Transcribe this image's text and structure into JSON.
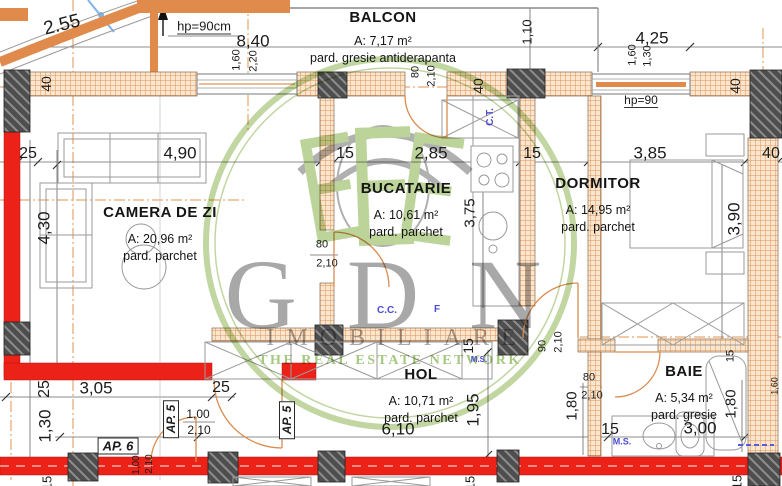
{
  "watermark": {
    "brand": "GDN",
    "subtitle": "IMOBILIARE",
    "tagline": "THE REAL ESTATE NETWORK"
  },
  "rooms": {
    "balcon": {
      "name": "BALCON",
      "area": "A: 7,17 m²",
      "floor": "pard. gresie antiderapanta"
    },
    "camera": {
      "name": "CAMERA DE ZI",
      "area": "A: 20,96 m²",
      "floor": "pard. parchet"
    },
    "bucatarie": {
      "name": "BUCATARIE",
      "area": "A: 10,61 m²",
      "floor": "pard. parchet"
    },
    "dormitor": {
      "name": "DORMITOR",
      "area": "A: 14,95 m²",
      "floor": "pard. parchet"
    },
    "hol": {
      "name": "HOL",
      "area": "A: 10,71 m²",
      "floor": "pard. parchet"
    },
    "baie": {
      "name": "BAIE",
      "area": "A: 5,34 m²",
      "floor": "pard. gresie"
    }
  },
  "labels": [
    {
      "t": "2.55",
      "x": 62,
      "y": 25,
      "r": -14,
      "s": 19
    },
    {
      "t": "hp=90cm",
      "x": 204,
      "y": 27,
      "s": 13,
      "c": "ul"
    },
    {
      "t": "8,40",
      "x": 253,
      "y": 41,
      "s": 17
    },
    {
      "t": "1,10",
      "x": 527,
      "y": 32,
      "r": -90,
      "s": 13
    },
    {
      "t": "4,25",
      "x": 652,
      "y": 38,
      "s": 17
    },
    {
      "t": "1,60",
      "x": 237,
      "y": 60,
      "r": -90,
      "s": 11
    },
    {
      "t": "2,20",
      "x": 254,
      "y": 61,
      "r": -90,
      "s": 11
    },
    {
      "t": "1,60",
      "x": 633,
      "y": 55,
      "r": -90,
      "s": 11
    },
    {
      "t": "1,30",
      "x": 648,
      "y": 56,
      "r": -90,
      "s": 11
    },
    {
      "t": "80",
      "x": 416,
      "y": 72,
      "r": -90,
      "s": 11
    },
    {
      "t": "2,10",
      "x": 432,
      "y": 76,
      "r": -90,
      "s": 11
    },
    {
      "t": "40",
      "x": 478,
      "y": 86,
      "r": -90,
      "s": 14
    },
    {
      "t": "40",
      "x": 46,
      "y": 84,
      "r": -90,
      "s": 14
    },
    {
      "t": "40",
      "x": 735,
      "y": 86,
      "r": -90,
      "s": 14
    },
    {
      "t": "hp=90",
      "x": 641,
      "y": 101,
      "s": 12,
      "c": "ul"
    },
    {
      "t": "25",
      "x": 28,
      "y": 154,
      "s": 16
    },
    {
      "t": "4,90",
      "x": 180,
      "y": 153,
      "s": 17
    },
    {
      "t": "15",
      "x": 345,
      "y": 154,
      "s": 16
    },
    {
      "t": "2,85",
      "x": 431,
      "y": 153,
      "s": 17
    },
    {
      "t": "15",
      "x": 532,
      "y": 154,
      "s": 16
    },
    {
      "t": "3,85",
      "x": 650,
      "y": 153,
      "s": 17
    },
    {
      "t": "40",
      "x": 771,
      "y": 154,
      "s": 16
    },
    {
      "t": "4,30",
      "x": 44,
      "y": 228,
      "r": -90,
      "s": 17
    },
    {
      "t": "3,75",
      "x": 470,
      "y": 213,
      "r": -90,
      "s": 15
    },
    {
      "t": "3,90",
      "x": 734,
      "y": 219,
      "r": -90,
      "s": 17
    },
    {
      "t": "C.T.",
      "x": 491,
      "y": 117,
      "r": -90,
      "s": 10,
      "c": "blue"
    },
    {
      "t": "80",
      "x": 322,
      "y": 245,
      "s": 11
    },
    {
      "t": "2,10",
      "x": 327,
      "y": 264,
      "s": 11
    },
    {
      "t": "C.C.",
      "x": 387,
      "y": 311,
      "s": 10,
      "c": "blue"
    },
    {
      "t": "F",
      "x": 437,
      "y": 310,
      "s": 10,
      "c": "blue"
    },
    {
      "t": "15",
      "x": 468,
      "y": 346,
      "r": -90,
      "s": 14
    },
    {
      "t": "M.S.",
      "x": 479,
      "y": 360,
      "s": 8,
      "c": "blue"
    },
    {
      "t": "90",
      "x": 543,
      "y": 346,
      "r": -90,
      "s": 11
    },
    {
      "t": "2,10",
      "x": 559,
      "y": 342,
      "r": -90,
      "s": 11
    },
    {
      "t": "80",
      "x": 589,
      "y": 378,
      "s": 11
    },
    {
      "t": "2,10",
      "x": 592,
      "y": 396,
      "s": 11
    },
    {
      "t": "1,80",
      "x": 572,
      "y": 406,
      "r": -90,
      "s": 15
    },
    {
      "t": "1,80",
      "x": 731,
      "y": 404,
      "r": -90,
      "s": 15
    },
    {
      "t": "15",
      "x": 731,
      "y": 356,
      "r": -90,
      "s": 11
    },
    {
      "t": "1,60",
      "x": 775,
      "y": 386,
      "r": -90,
      "s": 9
    },
    {
      "t": "25",
      "x": 45,
      "y": 389,
      "r": -90,
      "s": 16
    },
    {
      "t": "3,05",
      "x": 96,
      "y": 388,
      "s": 17
    },
    {
      "t": "25",
      "x": 221,
      "y": 388,
      "s": 16
    },
    {
      "t": "1,30",
      "x": 45,
      "y": 426,
      "r": -90,
      "s": 17
    },
    {
      "t": "1,00",
      "x": 198,
      "y": 414,
      "s": 12
    },
    {
      "t": "2,10",
      "x": 199,
      "y": 430,
      "s": 12
    },
    {
      "t": "6,10",
      "x": 398,
      "y": 429,
      "s": 17
    },
    {
      "t": "1,95",
      "x": 473,
      "y": 410,
      "r": -90,
      "s": 17
    },
    {
      "t": "15",
      "x": 610,
      "y": 430,
      "s": 16
    },
    {
      "t": "3,00",
      "x": 700,
      "y": 428,
      "s": 17
    },
    {
      "t": "M.S.",
      "x": 622,
      "y": 442,
      "s": 9,
      "c": "blue"
    },
    {
      "t": "1,00",
      "x": 137,
      "y": 465,
      "r": -90,
      "s": 10
    },
    {
      "t": "2,10",
      "x": 150,
      "y": 464,
      "r": -90,
      "s": 10
    },
    {
      "t": "15",
      "x": 47,
      "y": 483,
      "r": -90,
      "s": 13
    },
    {
      "t": "15",
      "x": 470,
      "y": 483,
      "r": -90,
      "s": 13
    },
    {
      "t": "15",
      "x": 737,
      "y": 482,
      "r": -90,
      "s": 13
    },
    {
      "t": "AP. 5",
      "x": 171,
      "y": 419,
      "r": -90,
      "s": 12,
      "c": "ap"
    },
    {
      "t": "AP. 5",
      "x": 287,
      "y": 420,
      "r": -90,
      "s": 12,
      "c": "ap"
    },
    {
      "t": "AP. 6",
      "x": 118,
      "y": 446,
      "s": 13,
      "c": "ap"
    }
  ],
  "colors": {
    "wall_hatch": "#E2954F",
    "wall_red": "#EC2218",
    "column_dark": "#4E4E4E",
    "door_arc": "#D98C4F",
    "annotation_blue": "#4B4BD0",
    "watermark_green": "#AFCB87",
    "watermark_gray": "#8F8F8F"
  }
}
